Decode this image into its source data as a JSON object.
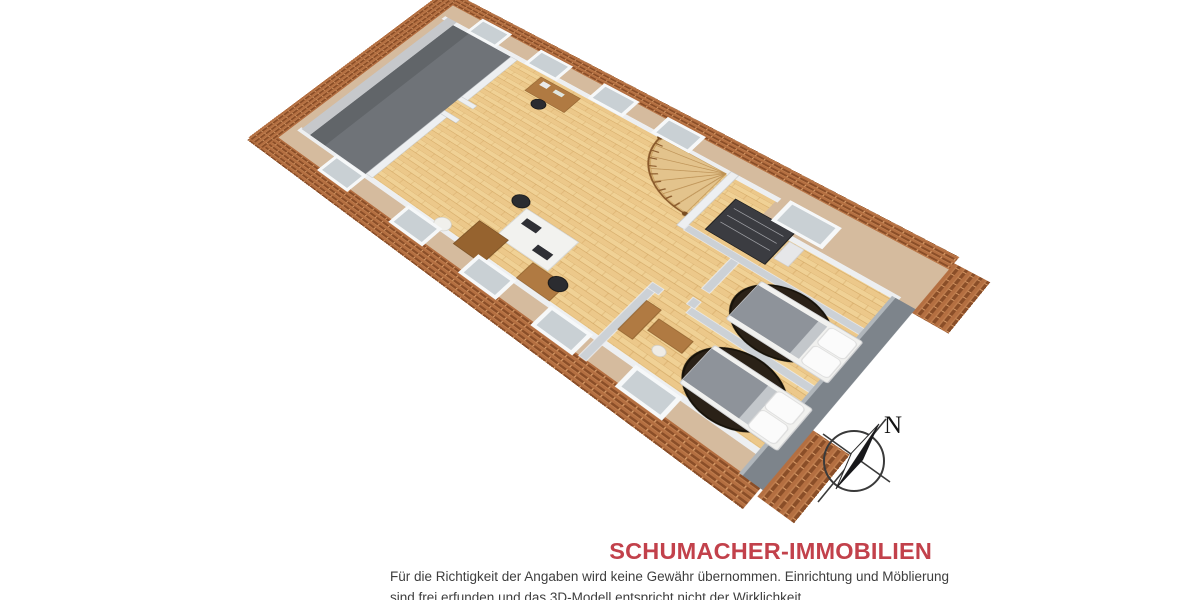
{
  "page": {
    "background": "#ffffff"
  },
  "branding": {
    "title": "SCHUMACHER-IMMOBILIEN",
    "color": "#c2414b"
  },
  "disclaimer": {
    "line1": "Für die Richtigkeit der Angaben wird keine Gewähr übernommen. Einrichtung und Möblierung",
    "line2": "sind frei erfunden und das 3D-Modell entspricht nicht der Wirklichkeit."
  },
  "compass": {
    "label": "N"
  },
  "floorplan": {
    "type": "3d-isometric-attic-floorplan",
    "colors": {
      "wood_base": "#ecc88a",
      "wood_line": "#b9883f",
      "tile_base": "#b46f41",
      "tile_dark": "#8a4e28",
      "tile_light": "#d89a66",
      "slope": "#d5bb9e",
      "attic_floor": "#6f7378",
      "wall_white": "#edeff1",
      "wall_gray": "#ccd1d6",
      "wall_outer": "#7d848b",
      "rug": "#2a2117",
      "stair_wood": "#8a5a2b",
      "desk_wood": "#b07a42"
    },
    "features": [
      "roof-tile-eaves",
      "skylight-windows",
      "attic-storage-strip",
      "knee-wall",
      "spiral-staircase",
      "closet-wardrobe",
      "office-desk-group",
      "office-chairs",
      "double-bed-1",
      "double-bed-2",
      "round-rugs",
      "dresser",
      "compass-rose"
    ]
  }
}
